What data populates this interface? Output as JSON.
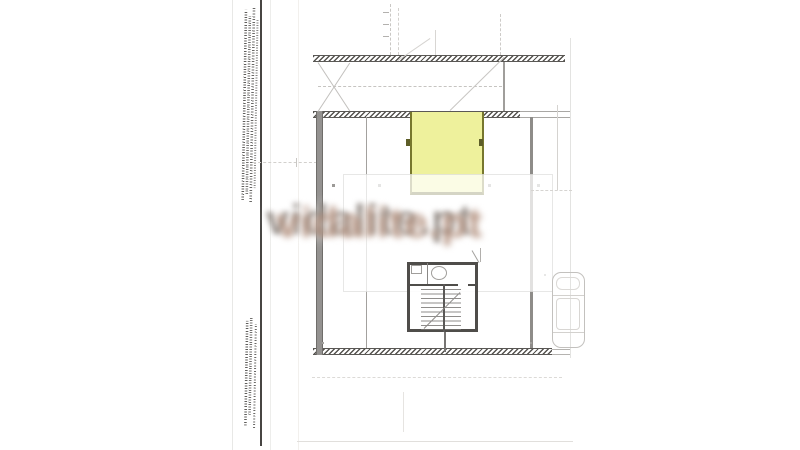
{
  "document": {
    "kind": "scanned architectural floor plan, basement parking level",
    "watermark": {
      "text": "vidalite.pt",
      "front_color": "#ab8571",
      "back_color": "#6e635b"
    },
    "highlighted_room": {
      "fill_color": "#eef19c",
      "border_color": "#60602a",
      "meaning": "highlighted parking/storage space on plan"
    },
    "stamps": {
      "top_left": {
        "legible": false,
        "orientation": "rotated-90"
      },
      "bottom_left": {
        "legible": false,
        "orientation": "rotated-90"
      }
    }
  }
}
